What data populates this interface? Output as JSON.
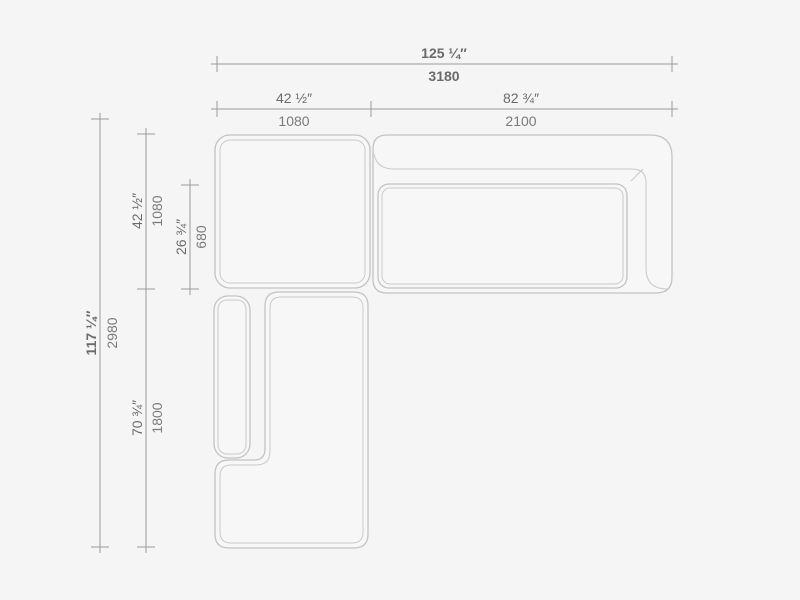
{
  "drawing": {
    "title": "Sectional sofa top-view dimension drawing",
    "colors": {
      "background": "#f5f5f5",
      "furniture_outline": "#c3c3c3",
      "dimension_line": "#9a9a9a",
      "dimension_text": "#6f6f6f"
    },
    "dims": {
      "total_width": {
        "inches": "125 ¼″",
        "mm": "3180"
      },
      "module_left_width": {
        "inches": "42 ½″",
        "mm": "1080"
      },
      "module_right_width": {
        "inches": "82 ¾″",
        "mm": "2100"
      },
      "total_depth": {
        "inches": "117 ¼″",
        "mm": "2980"
      },
      "module_top_depth": {
        "inches": "42 ½″",
        "mm": "1080"
      },
      "seat_inner_depth": {
        "inches": "26 ¾″",
        "mm": "680"
      },
      "module_bottom_depth": {
        "inches": "70 ¾″",
        "mm": "1800"
      }
    }
  }
}
